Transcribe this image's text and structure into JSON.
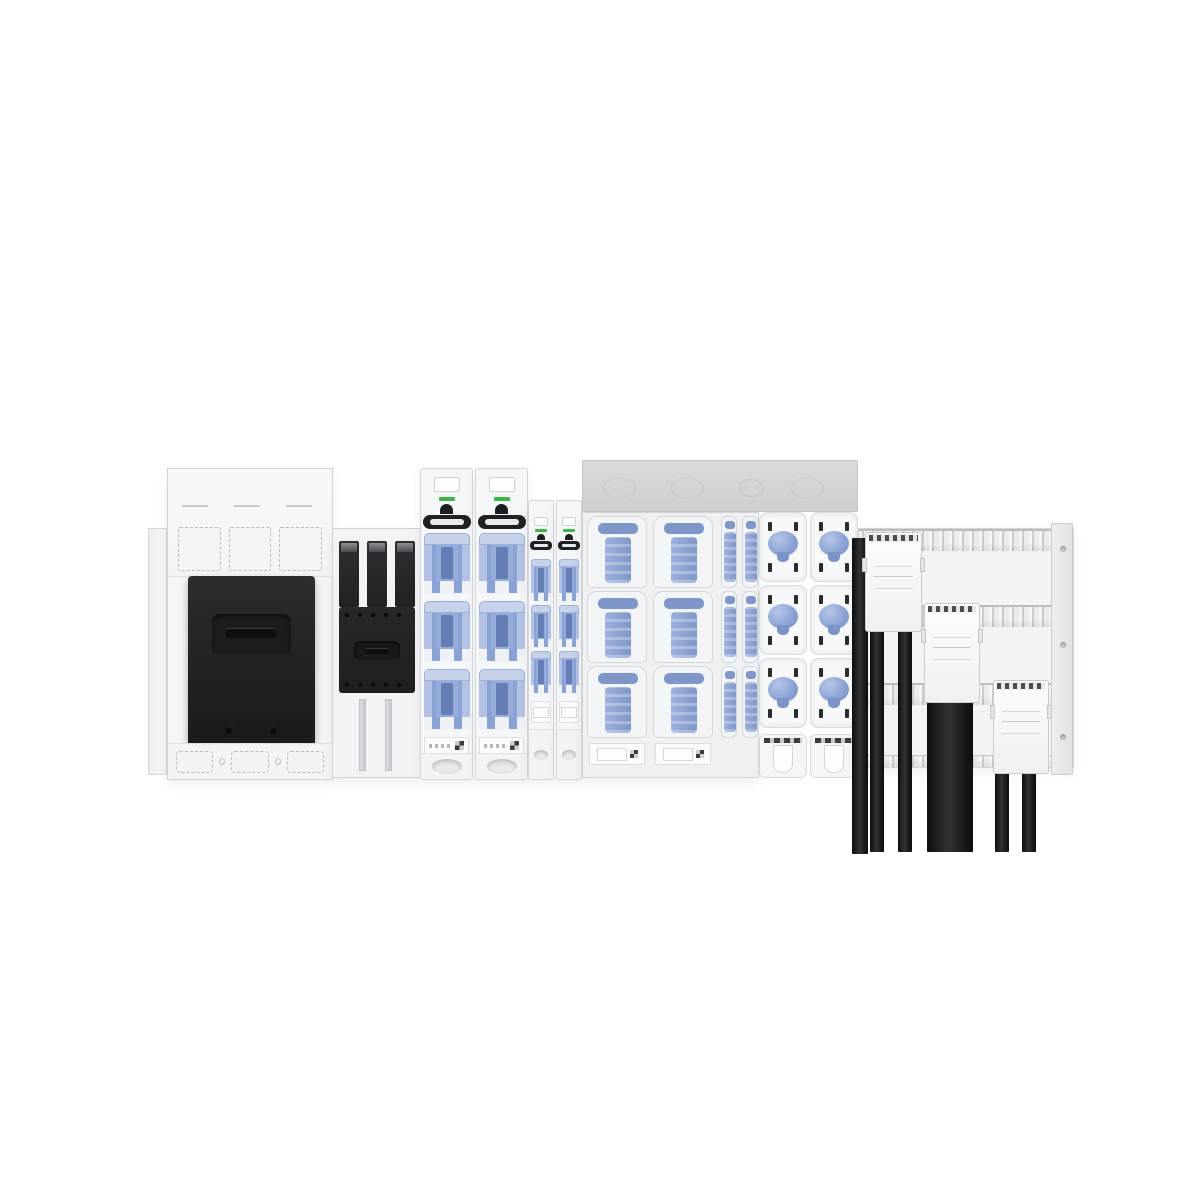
{
  "scene": {
    "label": "Low-voltage switchgear lineup mounted on a busbar system with outgoing cables",
    "background": "#ffffff"
  },
  "palette": {
    "panel_white": "#f5f6f7",
    "panel_bright": "#fbfcfd",
    "edge_gray": "#c9cdd1",
    "band_gray": "#d3d5d8",
    "device_black": "#212326",
    "fuse_blue": "#8ba3d4",
    "fuse_blue_dark": "#647eb5",
    "fuse_blue_light": "#c6d1ea",
    "indicator_green": "#3eb44a",
    "cable_black": "#17181a"
  },
  "components": {
    "side_rail": {
      "label": "left end panel"
    },
    "unitA": {
      "label": "panel-mounted switch disconnector with black cover"
    },
    "unitB": {
      "label": "molded case circuit breaker on mounting plate"
    },
    "unitC": {
      "label": "large vertical fuse switch disconnectors with green indicators"
    },
    "unitD": {
      "label": "narrow vertical fuse strips with green indicators"
    },
    "unitE": {
      "label": "fuse pull-out distribution section"
    },
    "unitF": {
      "label": "fuse boxes with blue rotary knobs"
    },
    "busbar": {
      "label": "busbar panel with cable connection adapters"
    },
    "cables": {
      "label": "black outgoing power cables"
    }
  },
  "counts": {
    "fuse_rows_per_column": 3,
    "mccb_poles": 3,
    "knob_rows_per_column": 3,
    "cable_adapters": 3,
    "thin_cables": 5,
    "wide_cables": 1
  },
  "repeats": {
    "rows3": [
      1,
      2,
      3
    ],
    "poles3": [
      1,
      2,
      3
    ],
    "knockouts3": [
      1,
      2,
      3
    ]
  }
}
